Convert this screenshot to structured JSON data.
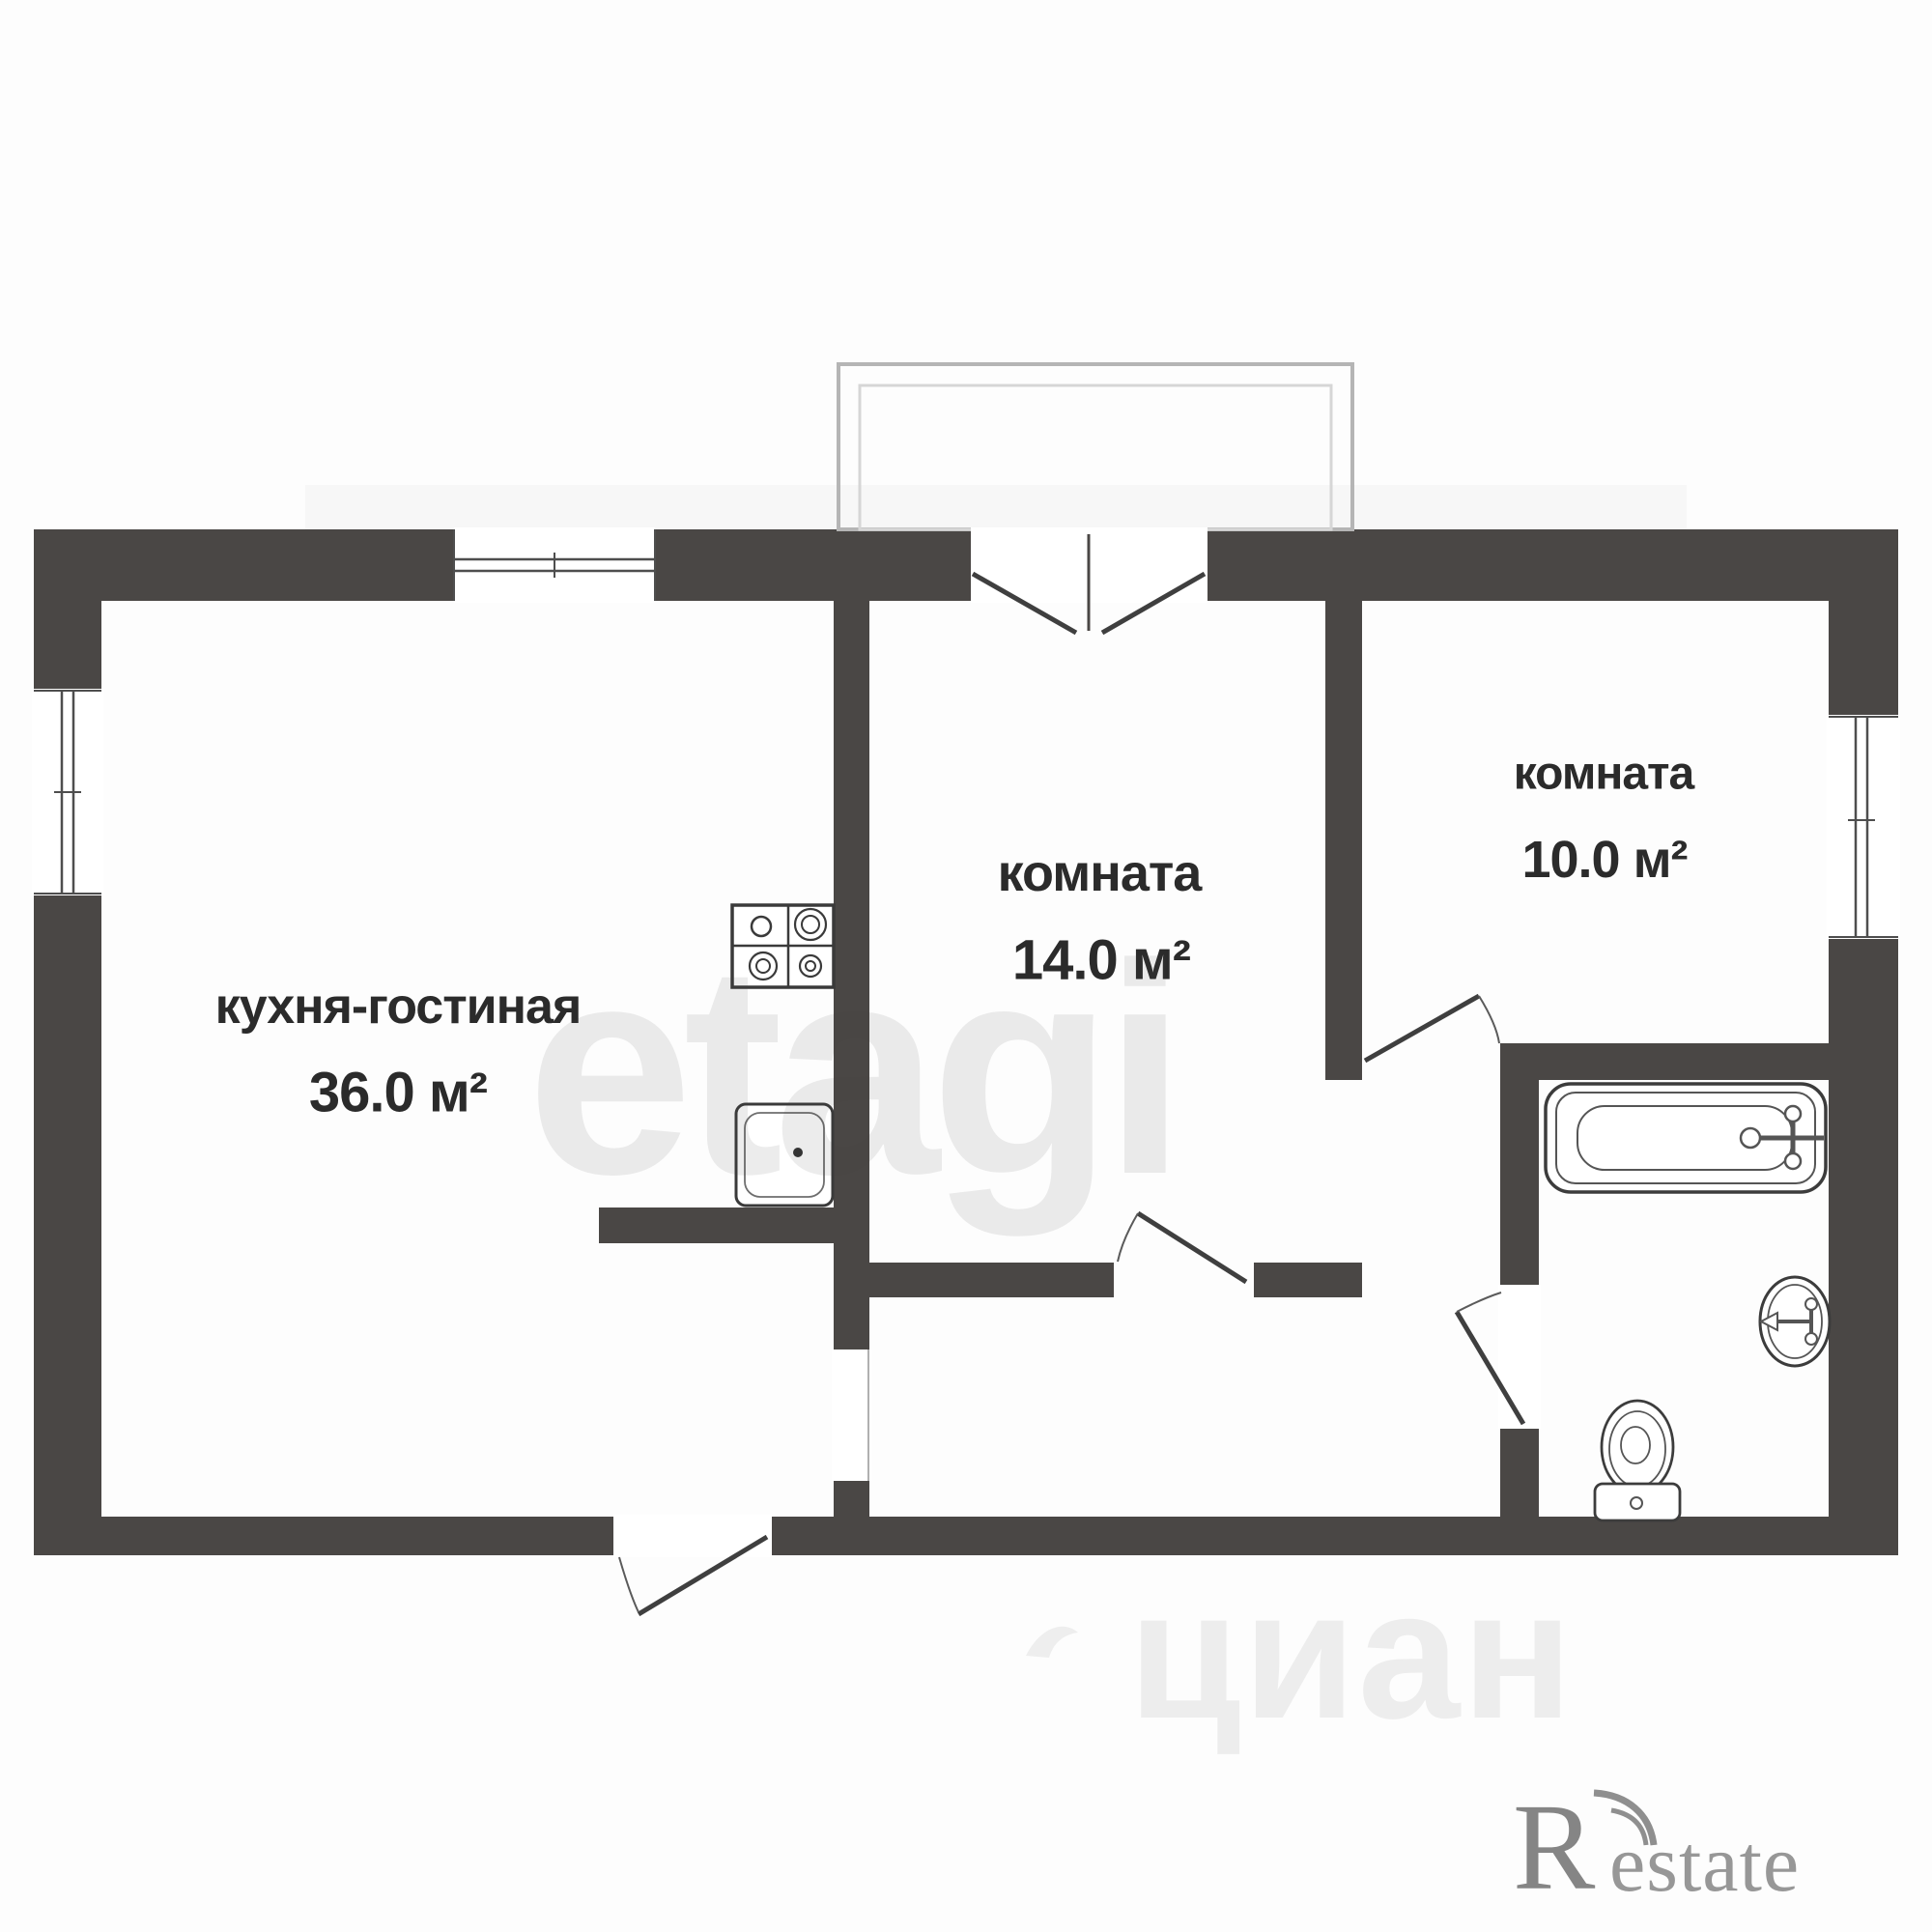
{
  "floor_plan": {
    "rooms": [
      {
        "name": "кухня-гостиная",
        "area": "36.0 м²"
      },
      {
        "name": "комната",
        "area": "14.0 м²"
      },
      {
        "name": "комната",
        "area": "10.0 м²"
      }
    ],
    "fixtures": [
      "stove-icon",
      "kitchen-sink-icon",
      "bathtub-icon",
      "washbasin-icon",
      "toilet-icon",
      "balcony-railing-icon",
      "window-icon",
      "door-swing-icon"
    ],
    "colors": {
      "wall": "#4a4745",
      "fixture_stroke": "#3c3c3c",
      "label_text": "#2b2b2b",
      "balcony_railing": "#bdbdbd",
      "watermark": "rgba(70,70,70,0.10)"
    }
  },
  "watermarks": {
    "center": "etagi",
    "bottom": "циан",
    "brand_letter": "R",
    "brand_rest": "estate"
  }
}
